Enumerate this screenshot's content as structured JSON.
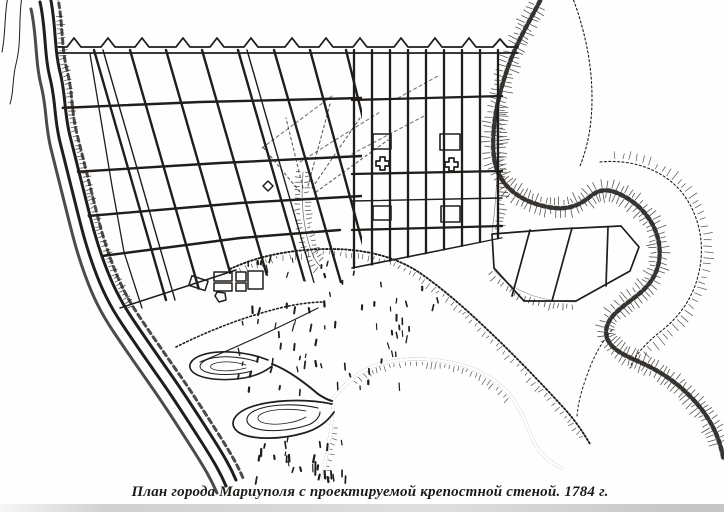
{
  "figure": {
    "caption": "План города Мариуполя с проектируемой крепостной стеной. 1784 г.",
    "subject": "План города Мариуполя",
    "year_shown": "1784 г.",
    "kind": "scanned engraved city plan"
  },
  "colors": {
    "ink": "#201d1a",
    "paper": "#fefefe",
    "smudge": "#bdbdbd"
  },
  "features": [
    "fortress-wall-with-bastions",
    "sheared-street-grid",
    "rectangular-street-grid",
    "church-markers",
    "ravine-stream-left",
    "river-with-hatched-banks-right",
    "river-meander-loop",
    "lowland-streams-with-contoured-lobes",
    "bluff-edge-hachures",
    "vegetation-dashes",
    "outbuilding-cluster"
  ]
}
